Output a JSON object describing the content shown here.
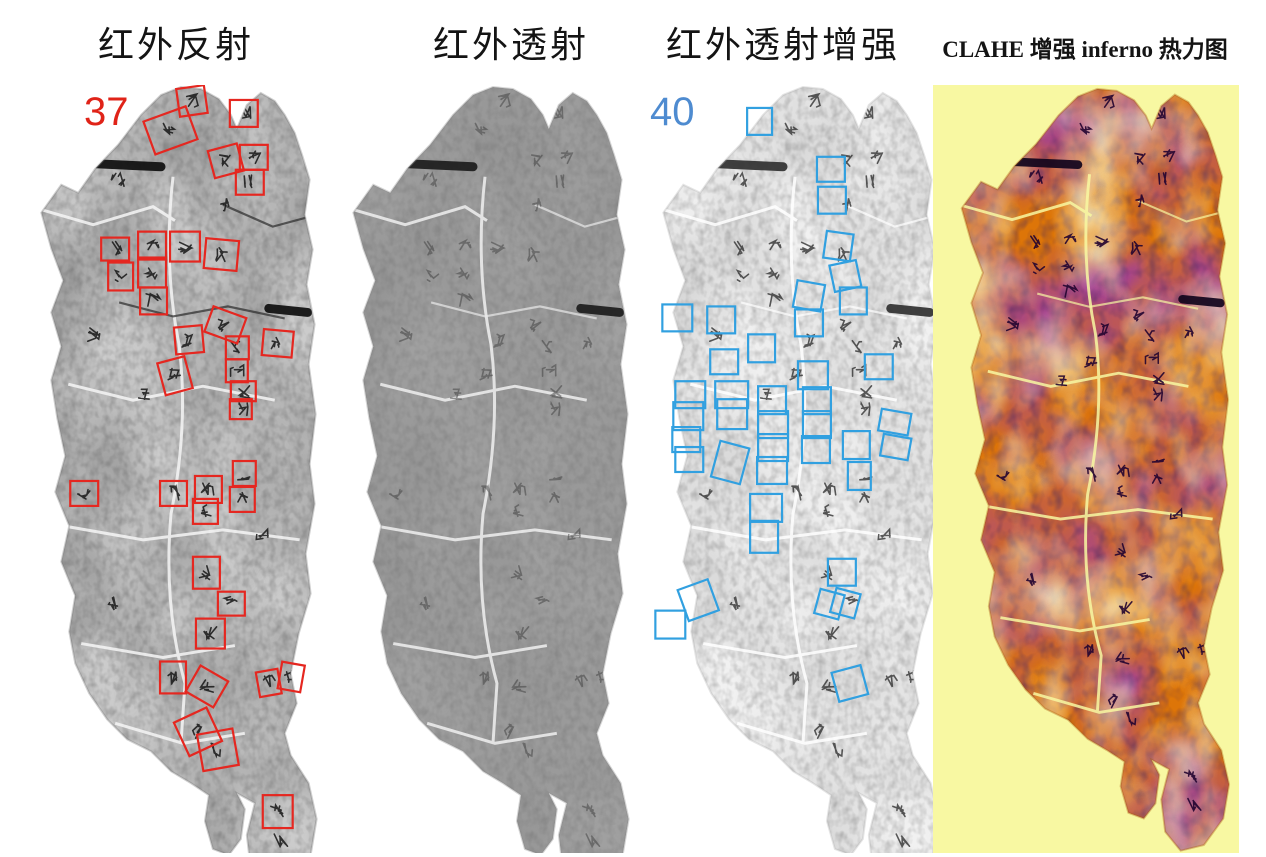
{
  "figure": {
    "type": "multi-panel artifact imaging comparison",
    "panels": [
      {
        "title": "红外反射",
        "count": "37",
        "count_color": "#e02318",
        "box_color": "#e52720",
        "boxes": [
          [
            155,
            2,
            28,
            28,
            -8
          ],
          [
            125,
            28,
            45,
            35,
            -20
          ],
          [
            207,
            15,
            28,
            27,
            0
          ],
          [
            188,
            62,
            30,
            28,
            -15
          ],
          [
            217,
            60,
            28,
            25,
            0
          ],
          [
            213,
            85,
            28,
            25,
            0
          ],
          [
            78,
            153,
            28,
            23,
            0
          ],
          [
            115,
            147,
            28,
            28,
            0
          ],
          [
            147,
            147,
            30,
            30,
            0
          ],
          [
            182,
            155,
            33,
            30,
            5
          ],
          [
            85,
            178,
            25,
            28,
            0
          ],
          [
            115,
            173,
            28,
            30,
            0
          ],
          [
            117,
            203,
            27,
            27,
            0
          ],
          [
            185,
            227,
            35,
            27,
            20
          ],
          [
            152,
            242,
            28,
            27,
            -5
          ],
          [
            240,
            246,
            30,
            26,
            5
          ],
          [
            203,
            252,
            23,
            23,
            0
          ],
          [
            138,
            275,
            28,
            33,
            -15
          ],
          [
            203,
            275,
            22,
            23,
            0
          ],
          [
            208,
            297,
            25,
            20,
            0
          ],
          [
            207,
            315,
            22,
            20,
            0
          ],
          [
            47,
            397,
            28,
            25,
            0
          ],
          [
            137,
            397,
            27,
            25,
            0
          ],
          [
            172,
            392,
            27,
            27,
            0
          ],
          [
            170,
            415,
            25,
            25,
            0
          ],
          [
            210,
            377,
            23,
            25,
            0
          ],
          [
            207,
            403,
            25,
            25,
            0
          ],
          [
            170,
            473,
            27,
            32,
            0
          ],
          [
            195,
            508,
            27,
            24,
            0
          ],
          [
            173,
            535,
            29,
            30,
            0
          ],
          [
            137,
            578,
            26,
            32,
            0
          ],
          [
            168,
            588,
            32,
            30,
            30
          ],
          [
            235,
            587,
            22,
            25,
            -10
          ],
          [
            257,
            580,
            23,
            27,
            10
          ],
          [
            157,
            630,
            36,
            37,
            -25
          ],
          [
            177,
            648,
            36,
            37,
            -10
          ],
          [
            240,
            712,
            30,
            33,
            0
          ]
        ]
      },
      {
        "title": "红外透射"
      },
      {
        "title": "红外透射增强",
        "count": "40",
        "count_color": "#4e8bd0",
        "box_color": "#31a0e0",
        "boxes": [
          [
            102,
            23,
            25,
            27,
            0
          ],
          [
            172,
            72,
            28,
            25,
            0
          ],
          [
            173,
            102,
            28,
            27,
            0
          ],
          [
            180,
            148,
            27,
            27,
            8
          ],
          [
            187,
            178,
            27,
            27,
            -12
          ],
          [
            150,
            198,
            28,
            27,
            10
          ],
          [
            195,
            203,
            27,
            27,
            0
          ],
          [
            17,
            220,
            30,
            27,
            0
          ],
          [
            62,
            222,
            28,
            27,
            0
          ],
          [
            150,
            225,
            28,
            27,
            0
          ],
          [
            103,
            250,
            27,
            28,
            0
          ],
          [
            65,
            265,
            28,
            25,
            0
          ],
          [
            220,
            270,
            28,
            25,
            0
          ],
          [
            30,
            297,
            30,
            27,
            0
          ],
          [
            28,
            318,
            30,
            28,
            0
          ],
          [
            27,
            343,
            28,
            25,
            0
          ],
          [
            30,
            363,
            28,
            25,
            0
          ],
          [
            70,
            297,
            33,
            27,
            0
          ],
          [
            72,
            315,
            30,
            30,
            0
          ],
          [
            70,
            360,
            30,
            37,
            15
          ],
          [
            113,
            302,
            28,
            28,
            0
          ],
          [
            113,
            327,
            30,
            27,
            0
          ],
          [
            113,
            350,
            30,
            27,
            0
          ],
          [
            112,
            373,
            30,
            27,
            0
          ],
          [
            153,
            277,
            30,
            28,
            0
          ],
          [
            158,
            303,
            28,
            27,
            0
          ],
          [
            158,
            327,
            28,
            27,
            0
          ],
          [
            157,
            352,
            28,
            27,
            0
          ],
          [
            198,
            347,
            27,
            28,
            0
          ],
          [
            203,
            378,
            23,
            28,
            0
          ],
          [
            235,
            327,
            30,
            22,
            10
          ],
          [
            237,
            352,
            28,
            22,
            10
          ],
          [
            105,
            410,
            32,
            28,
            0
          ],
          [
            105,
            437,
            28,
            32,
            0
          ],
          [
            183,
            475,
            28,
            27,
            0
          ],
          [
            172,
            508,
            25,
            25,
            15
          ],
          [
            188,
            507,
            25,
            25,
            15
          ],
          [
            37,
            500,
            32,
            33,
            -20
          ],
          [
            10,
            527,
            30,
            28,
            0
          ],
          [
            190,
            585,
            30,
            30,
            -15
          ]
        ]
      },
      {
        "title": "CLAHE 增强  inferno 热力图",
        "background": "#f8f8a2",
        "palette": [
          "#fcffa4",
          "#f98e09",
          "#bc3754",
          "#57106e",
          "#000004"
        ]
      }
    ],
    "character_marks": [
      [
        169,
        16
      ],
      [
        147,
        45
      ],
      [
        221,
        28
      ],
      [
        203,
        76
      ],
      [
        231,
        72
      ],
      [
        227,
        97
      ],
      [
        95,
        95
      ],
      [
        200,
        120
      ],
      [
        92,
        164
      ],
      [
        129,
        161
      ],
      [
        162,
        162
      ],
      [
        198,
        170
      ],
      [
        97,
        192
      ],
      [
        129,
        188
      ],
      [
        130,
        216
      ],
      [
        70,
        250
      ],
      [
        202,
        240
      ],
      [
        166,
        256
      ],
      [
        255,
        258
      ],
      [
        214,
        263
      ],
      [
        152,
        291
      ],
      [
        214,
        286
      ],
      [
        220,
        307
      ],
      [
        218,
        325
      ],
      [
        120,
        310
      ],
      [
        61,
        409
      ],
      [
        150,
        409
      ],
      [
        185,
        405
      ],
      [
        182,
        427
      ],
      [
        221,
        389
      ],
      [
        219,
        415
      ],
      [
        240,
        450
      ],
      [
        183,
        489
      ],
      [
        208,
        520
      ],
      [
        90,
        520
      ],
      [
        187,
        550
      ],
      [
        150,
        594
      ],
      [
        184,
        603
      ],
      [
        246,
        599
      ],
      [
        268,
        593
      ],
      [
        175,
        648
      ],
      [
        195,
        666
      ],
      [
        255,
        728
      ],
      [
        258,
        757
      ]
    ]
  }
}
